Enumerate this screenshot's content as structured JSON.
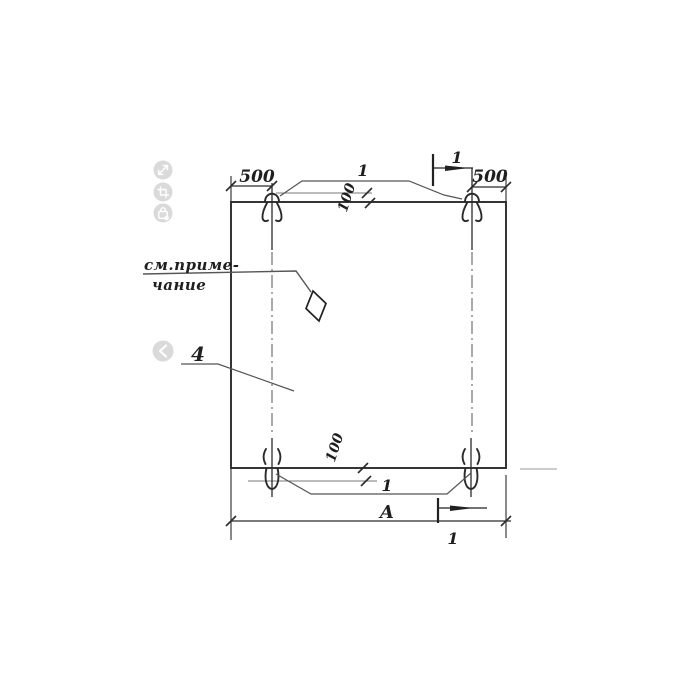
{
  "drawing": {
    "labels": {
      "dim_top_left": "500",
      "dim_top_right": "500",
      "loops_ref_top": "1",
      "loops_ref_bottom": "1",
      "section_top": "1",
      "section_bottom": "1",
      "offset_top": "100",
      "offset_bottom": "100",
      "overall_width": "А",
      "item": "4"
    },
    "note": {
      "line1": "см.приме-",
      "line2": "чание"
    },
    "colors": {
      "ink": "#2b2b2b",
      "thin_line": "#777777",
      "leader_line": "#555555",
      "faint_line": "#adadad",
      "paper": "#ffffff"
    }
  },
  "viewer": {
    "icon_background": "#dadada",
    "icons": [
      {
        "name": "expand-icon"
      },
      {
        "name": "crop-icon"
      },
      {
        "name": "lock-icon"
      },
      {
        "name": "chevron-left-icon"
      }
    ]
  }
}
